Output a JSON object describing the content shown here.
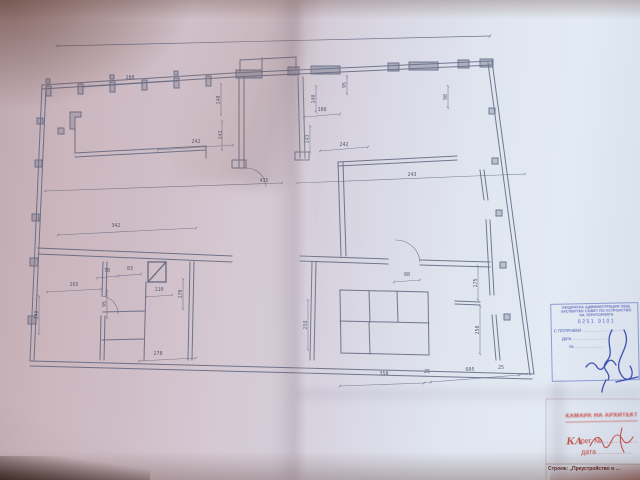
{
  "plan": {
    "dims": [
      "288",
      "242",
      "140",
      "143",
      "140",
      "188",
      "143",
      "242",
      "95",
      "90",
      "435",
      "243",
      "342",
      "265",
      "78",
      "83",
      "110",
      "170",
      "95",
      "148",
      "278",
      "258",
      "88",
      "175",
      "250",
      "358",
      "25",
      "605",
      "25"
    ]
  },
  "municipal_stamp": {
    "header_line1": "ОБЩИНСКА АДМИНИСТРАЦИЯ ОБЩ.",
    "header_line2": "ЕКСПЕРТЕН СЪВЕТ ПО УСТРОЙСТВО",
    "header_line3": "НА ТЕРИТОРИЯТА",
    "ref_number": "6251 9101",
    "approved_label": "С ПОПРАВКИ",
    "approved_dots": "............................",
    "date_label": "Дата",
    "date_dots": "........................",
    "number_label": "№",
    "number_dots": "...................."
  },
  "architect_stamp": {
    "header": "КАМАРА НА АРХИТЕКТИТЕ В БЪЛГАРИЯ",
    "logo_text": "КАБ",
    "reg_label": "рег. №",
    "reg_dots": "..............",
    "date_label": "дата",
    "date_dots": ".............."
  },
  "title_block": {
    "project_line": "Строеж: „Преустройство и ..."
  }
}
